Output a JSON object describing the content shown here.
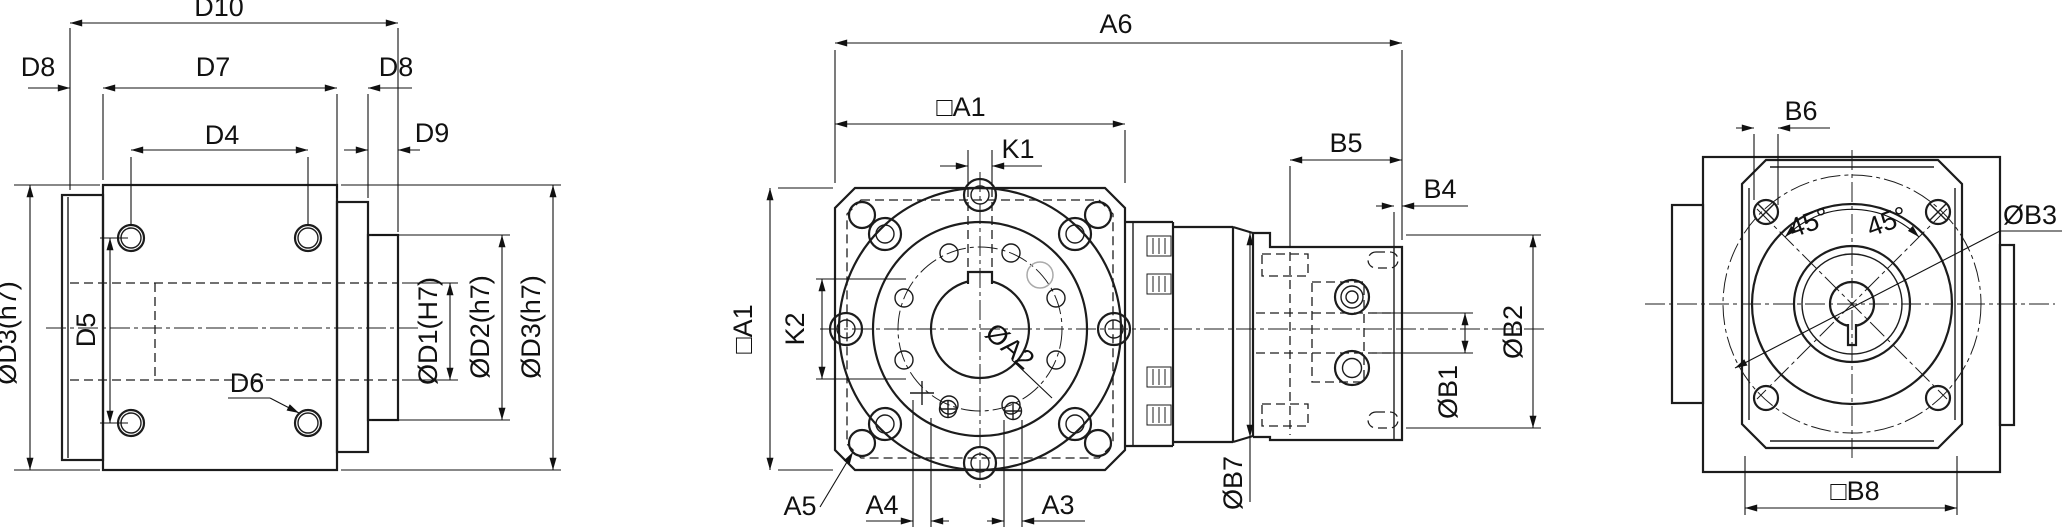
{
  "drawing": {
    "type": "technical-dimension-drawing",
    "description": "Three-view dimensional outline drawing of a right-angle gearbox with motor adapter",
    "colors": {
      "line": "#1c1c1c",
      "background": "#ffffff",
      "ghost_line": "#aaaaaa"
    },
    "views": {
      "side": {
        "name": "output-side-view",
        "labels": {
          "d10": "D10",
          "d8_left": "D8",
          "d7": "D7",
          "d4": "D4",
          "d8_right": "D8",
          "d9": "D9",
          "d5": "D5",
          "d6": "D6",
          "od3_left": "ØD3(h7)",
          "od1": "ØD1(H7)",
          "od2": "ØD2(h7)",
          "od3_right": "ØD3(h7)"
        }
      },
      "front": {
        "name": "front-view",
        "labels": {
          "a6": "A6",
          "a1_top": "□A1",
          "k1": "K1",
          "a1_left": "□A1",
          "k2": "K2",
          "oa2": "ØA2",
          "b5": "B5",
          "b4": "B4",
          "ob1": "ØB1",
          "ob2": "ØB2",
          "ob7": "ØB7",
          "a5": "A5",
          "a4": "A4",
          "a3": "A3"
        }
      },
      "rear": {
        "name": "motor-side-view",
        "labels": {
          "b6": "B6",
          "ob3": "ØB3",
          "angle_left": "45°",
          "angle_right": "45°",
          "b8": "□B8"
        }
      }
    }
  }
}
